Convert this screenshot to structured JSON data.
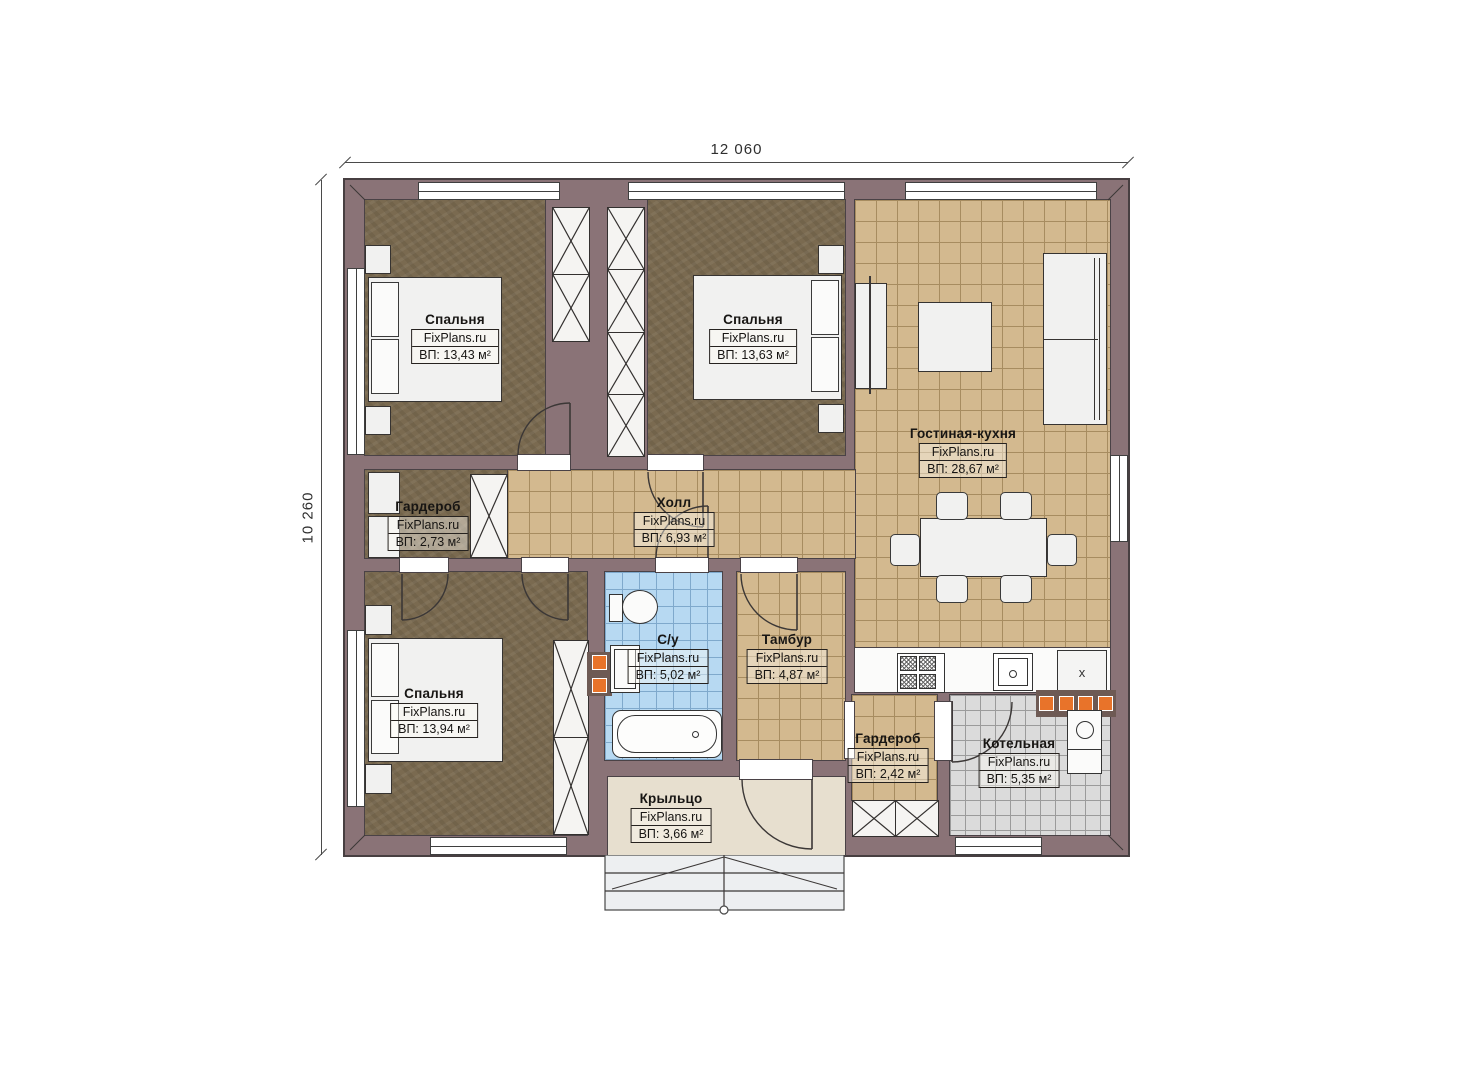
{
  "dimensions": {
    "width": "12 060",
    "height": "10 260"
  },
  "rooms": [
    {
      "id": "bedroom-1",
      "name": "Спальня",
      "brand": "FixPlans.ru",
      "area": "ВП: 13,43 м²"
    },
    {
      "id": "bedroom-2",
      "name": "Спальня",
      "brand": "FixPlans.ru",
      "area": "ВП: 13,63 м²"
    },
    {
      "id": "living-kitchen",
      "name": "Гостиная-кухня",
      "brand": "FixPlans.ru",
      "area": "ВП: 28,67 м²"
    },
    {
      "id": "wardrobe-1",
      "name": "Гардероб",
      "brand": "FixPlans.ru",
      "area": "ВП: 2,73 м²"
    },
    {
      "id": "hall",
      "name": "Холл",
      "brand": "FixPlans.ru",
      "area": "ВП: 6,93 м²"
    },
    {
      "id": "bathroom",
      "name": "С/у",
      "brand": "FixPlans.ru",
      "area": "ВП: 5,02 м²"
    },
    {
      "id": "vestibule",
      "name": "Тамбур",
      "brand": "FixPlans.ru",
      "area": "ВП: 4,87 м²"
    },
    {
      "id": "bedroom-3",
      "name": "Спальня",
      "brand": "FixPlans.ru",
      "area": "ВП: 13,94 м²"
    },
    {
      "id": "wardrobe-2",
      "name": "Гардероб",
      "brand": "FixPlans.ru",
      "area": "ВП: 2,42 м²"
    },
    {
      "id": "boiler-room",
      "name": "Котельная",
      "brand": "FixPlans.ru",
      "area": "ВП: 5,35 м²"
    },
    {
      "id": "porch",
      "name": "Крыльцо",
      "brand": "FixPlans.ru",
      "area": "ВП: 3,66 м²"
    }
  ],
  "kitchen": {
    "unit_label": "x"
  },
  "colors": {
    "wall": "#8a7377",
    "bedroom_floor": "#7a6a50",
    "tile_floor": "#d3b98f",
    "bathroom_tile": "#b7d9f2",
    "boiler_tile": "#dbdbdb",
    "porch_floor": "#e7dfcf",
    "accent_orange": "#e8732a",
    "furniture": "#f1f1f0",
    "line": "#3b3736"
  }
}
